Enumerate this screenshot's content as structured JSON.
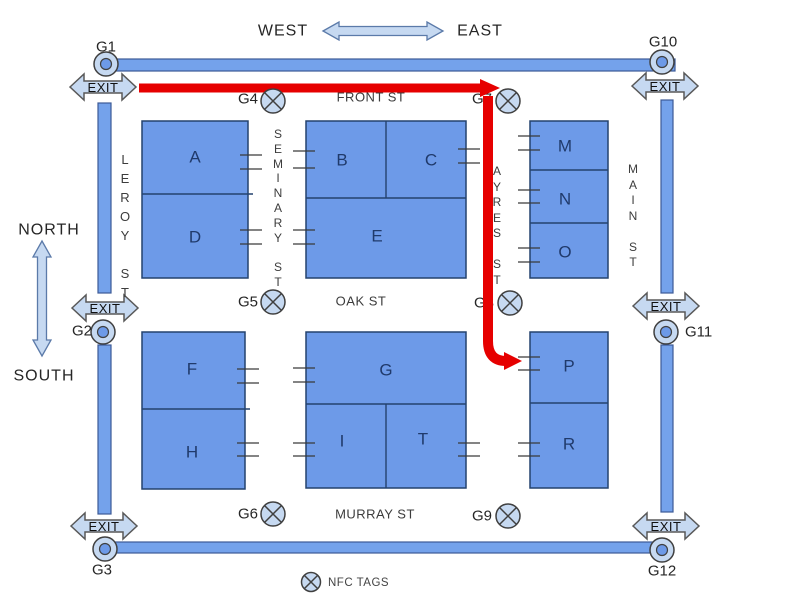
{
  "compass": {
    "north": "NORTH",
    "south": "SOUTH",
    "west": "WEST",
    "east": "EAST"
  },
  "streets": {
    "front": "FRONT ST",
    "oak": "OAK ST",
    "murray": "MURRAY ST",
    "leroy": "LEROY ST",
    "seminary": "SEMINARY ST",
    "ayres": "AYRES ST",
    "main": "MAIN ST"
  },
  "blocks": [
    {
      "id": "A",
      "label": "A"
    },
    {
      "id": "B",
      "label": "B"
    },
    {
      "id": "C",
      "label": "C"
    },
    {
      "id": "D",
      "label": "D"
    },
    {
      "id": "E",
      "label": "E"
    },
    {
      "id": "F",
      "label": "F"
    },
    {
      "id": "G",
      "label": "G"
    },
    {
      "id": "H",
      "label": "H"
    },
    {
      "id": "I",
      "label": "I"
    },
    {
      "id": "T",
      "label": "T"
    },
    {
      "id": "M",
      "label": "M"
    },
    {
      "id": "N",
      "label": "N"
    },
    {
      "id": "O",
      "label": "O"
    },
    {
      "id": "P",
      "label": "P"
    },
    {
      "id": "R",
      "label": "R"
    }
  ],
  "gates": {
    "perimeter": [
      {
        "id": "G1",
        "label": "G1"
      },
      {
        "id": "G2",
        "label": "G2"
      },
      {
        "id": "G3",
        "label": "G3"
      },
      {
        "id": "G10",
        "label": "G10"
      },
      {
        "id": "G11",
        "label": "G11"
      },
      {
        "id": "G12",
        "label": "G12"
      }
    ],
    "nfc": [
      {
        "id": "G4",
        "label": "G4"
      },
      {
        "id": "G5",
        "label": "G5"
      },
      {
        "id": "G6",
        "label": "G6"
      },
      {
        "id": "G7",
        "label": "G7"
      },
      {
        "id": "G8",
        "label": "G8"
      },
      {
        "id": "G9",
        "label": "G9"
      }
    ]
  },
  "exit_label": "EXIT",
  "legend": {
    "nfc_label": "NFC TAGS"
  },
  "colors": {
    "block_fill": "#6d9ae8",
    "street_fill": "#74a2eb",
    "light_blue": "#c6d9f1",
    "route_red": "#e60000",
    "letter_navy": "#203a6b"
  }
}
